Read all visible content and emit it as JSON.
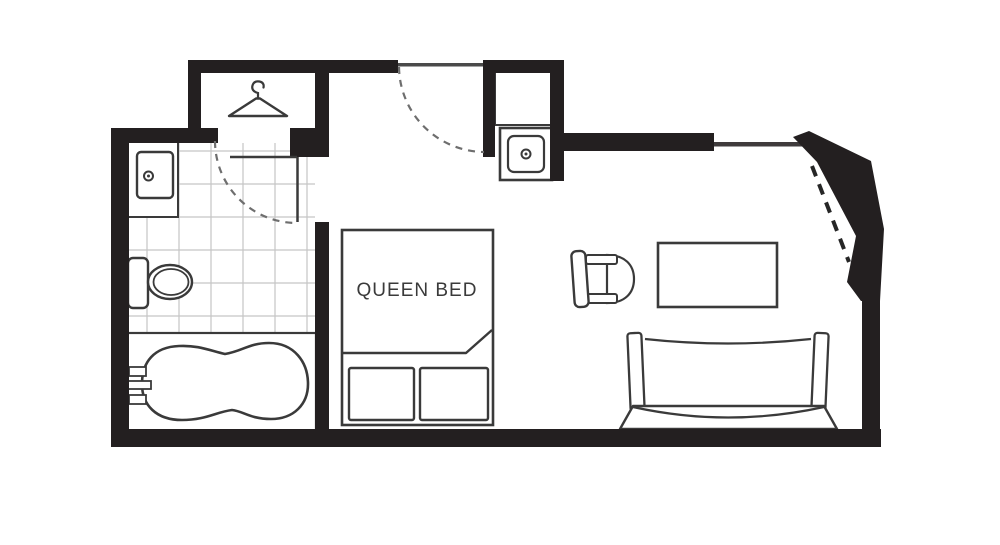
{
  "title": "Guest room floor plan",
  "labels": {
    "bed": "QUEEN BED"
  },
  "colors": {
    "bg": "#ffffff",
    "wall": "#231f20",
    "line": "#3a3a3a",
    "line_soft": "#6e6e6e",
    "grid": "#c5c5c5"
  },
  "icons": [
    "hanger-icon",
    "vanity-counter",
    "vanity-sink",
    "toilet",
    "bathtub",
    "bath-faucet",
    "alcove-counter",
    "alcove-sink",
    "queen-bed",
    "pillow",
    "armchair",
    "table",
    "sofa",
    "door-swing-dashed"
  ]
}
